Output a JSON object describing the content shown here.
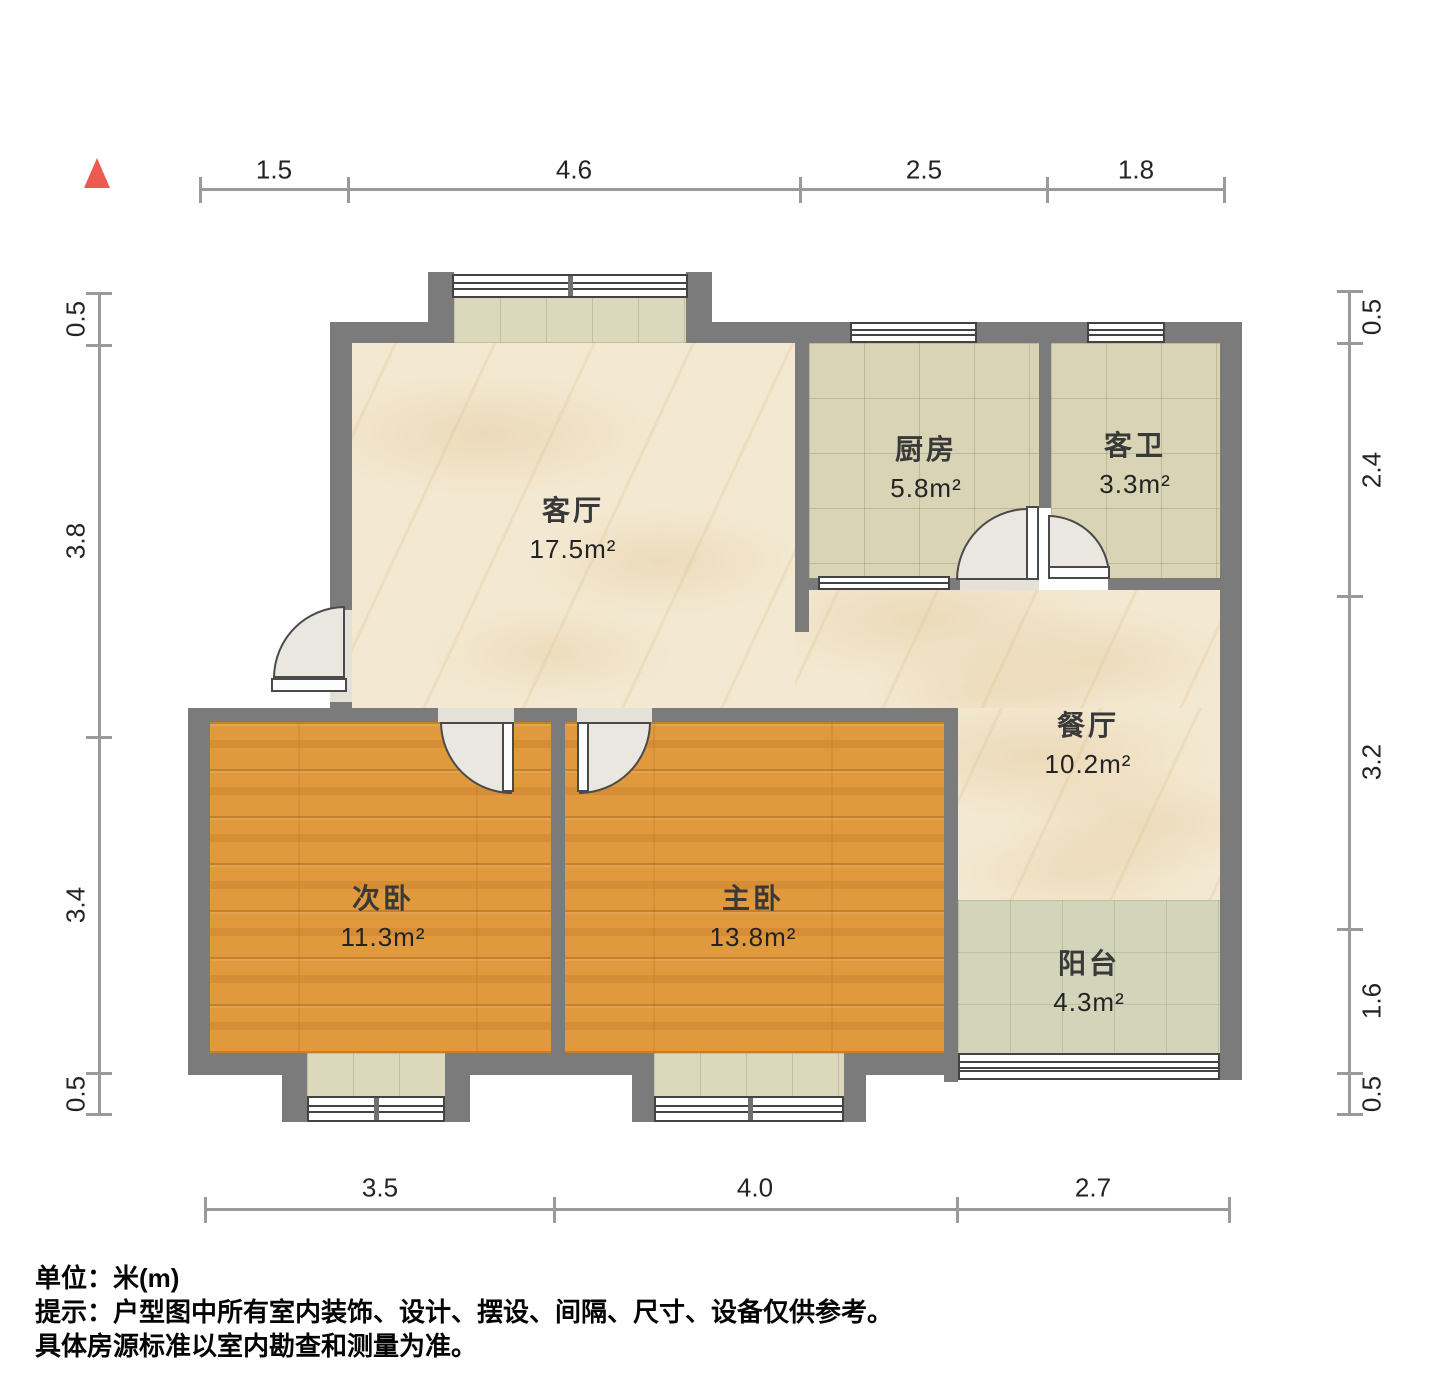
{
  "rooms": {
    "living": {
      "name": "客厅",
      "area": "17.5m²"
    },
    "kitchen": {
      "name": "厨房",
      "area": "5.8m²"
    },
    "bath": {
      "name": "客卫",
      "area": "3.3m²"
    },
    "dining": {
      "name": "餐厅",
      "area": "10.2m²"
    },
    "bedroom2": {
      "name": "次卧",
      "area": "11.3m²"
    },
    "bedroom1": {
      "name": "主卧",
      "area": "13.8m²"
    },
    "balcony": {
      "name": "阳台",
      "area": "4.3m²"
    }
  },
  "dimensions": {
    "top": [
      "1.5",
      "4.6",
      "2.5",
      "1.8"
    ],
    "left": [
      "0.5",
      "3.8",
      "3.4",
      "0.5"
    ],
    "right": [
      "0.5",
      "2.4",
      "3.2",
      "1.6",
      "0.5"
    ],
    "bottom": [
      "3.5",
      "4.0",
      "2.7"
    ]
  },
  "footnote": {
    "unit": "单位：米(m)",
    "tip": "提示：户型图中所有室内装饰、设计、摆设、间隔、尺寸、设备仅供参考。",
    "tip2": "具体房源标准以室内勘查和测量为准。"
  },
  "colors": {
    "wall": "#7b7b7b",
    "north_arrow": "#ec5a52",
    "marble_floor": "#f3e9d2",
    "tile_floor": "#d8d4b5",
    "wood_floor": "#e1993d",
    "balcony_floor": "#d3d5bb"
  }
}
